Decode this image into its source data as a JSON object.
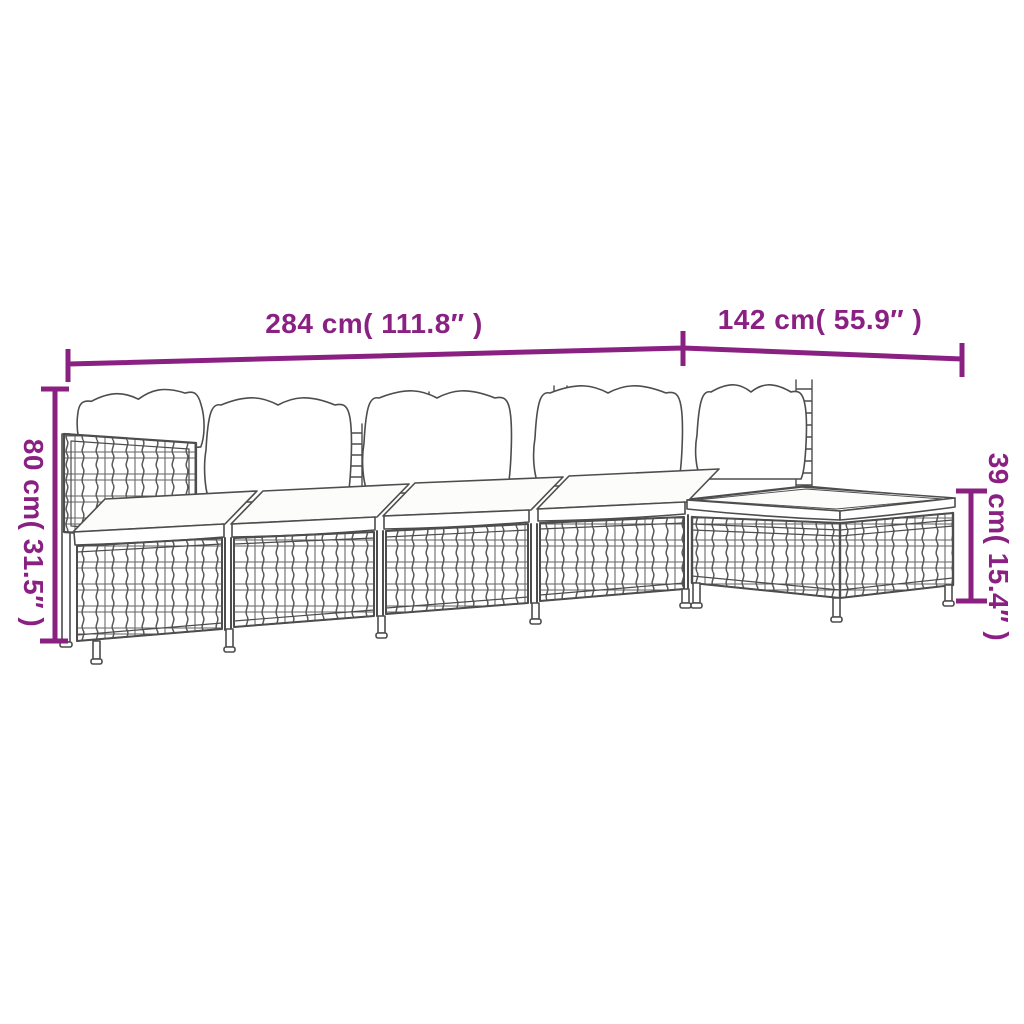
{
  "diagram": {
    "type": "product-dimension-illustration",
    "labels": {
      "width_total": "284 cm( 111.8″ )",
      "depth_total": "142 cm( 55.9″ )",
      "height_total": "80 cm( 31.5″ )",
      "footstool_height": "39 cm( 15.4″ )"
    },
    "colors": {
      "dimension": "#8A2082",
      "line_art": "#4D4D4D",
      "background": "#FFFFFF"
    }
  }
}
